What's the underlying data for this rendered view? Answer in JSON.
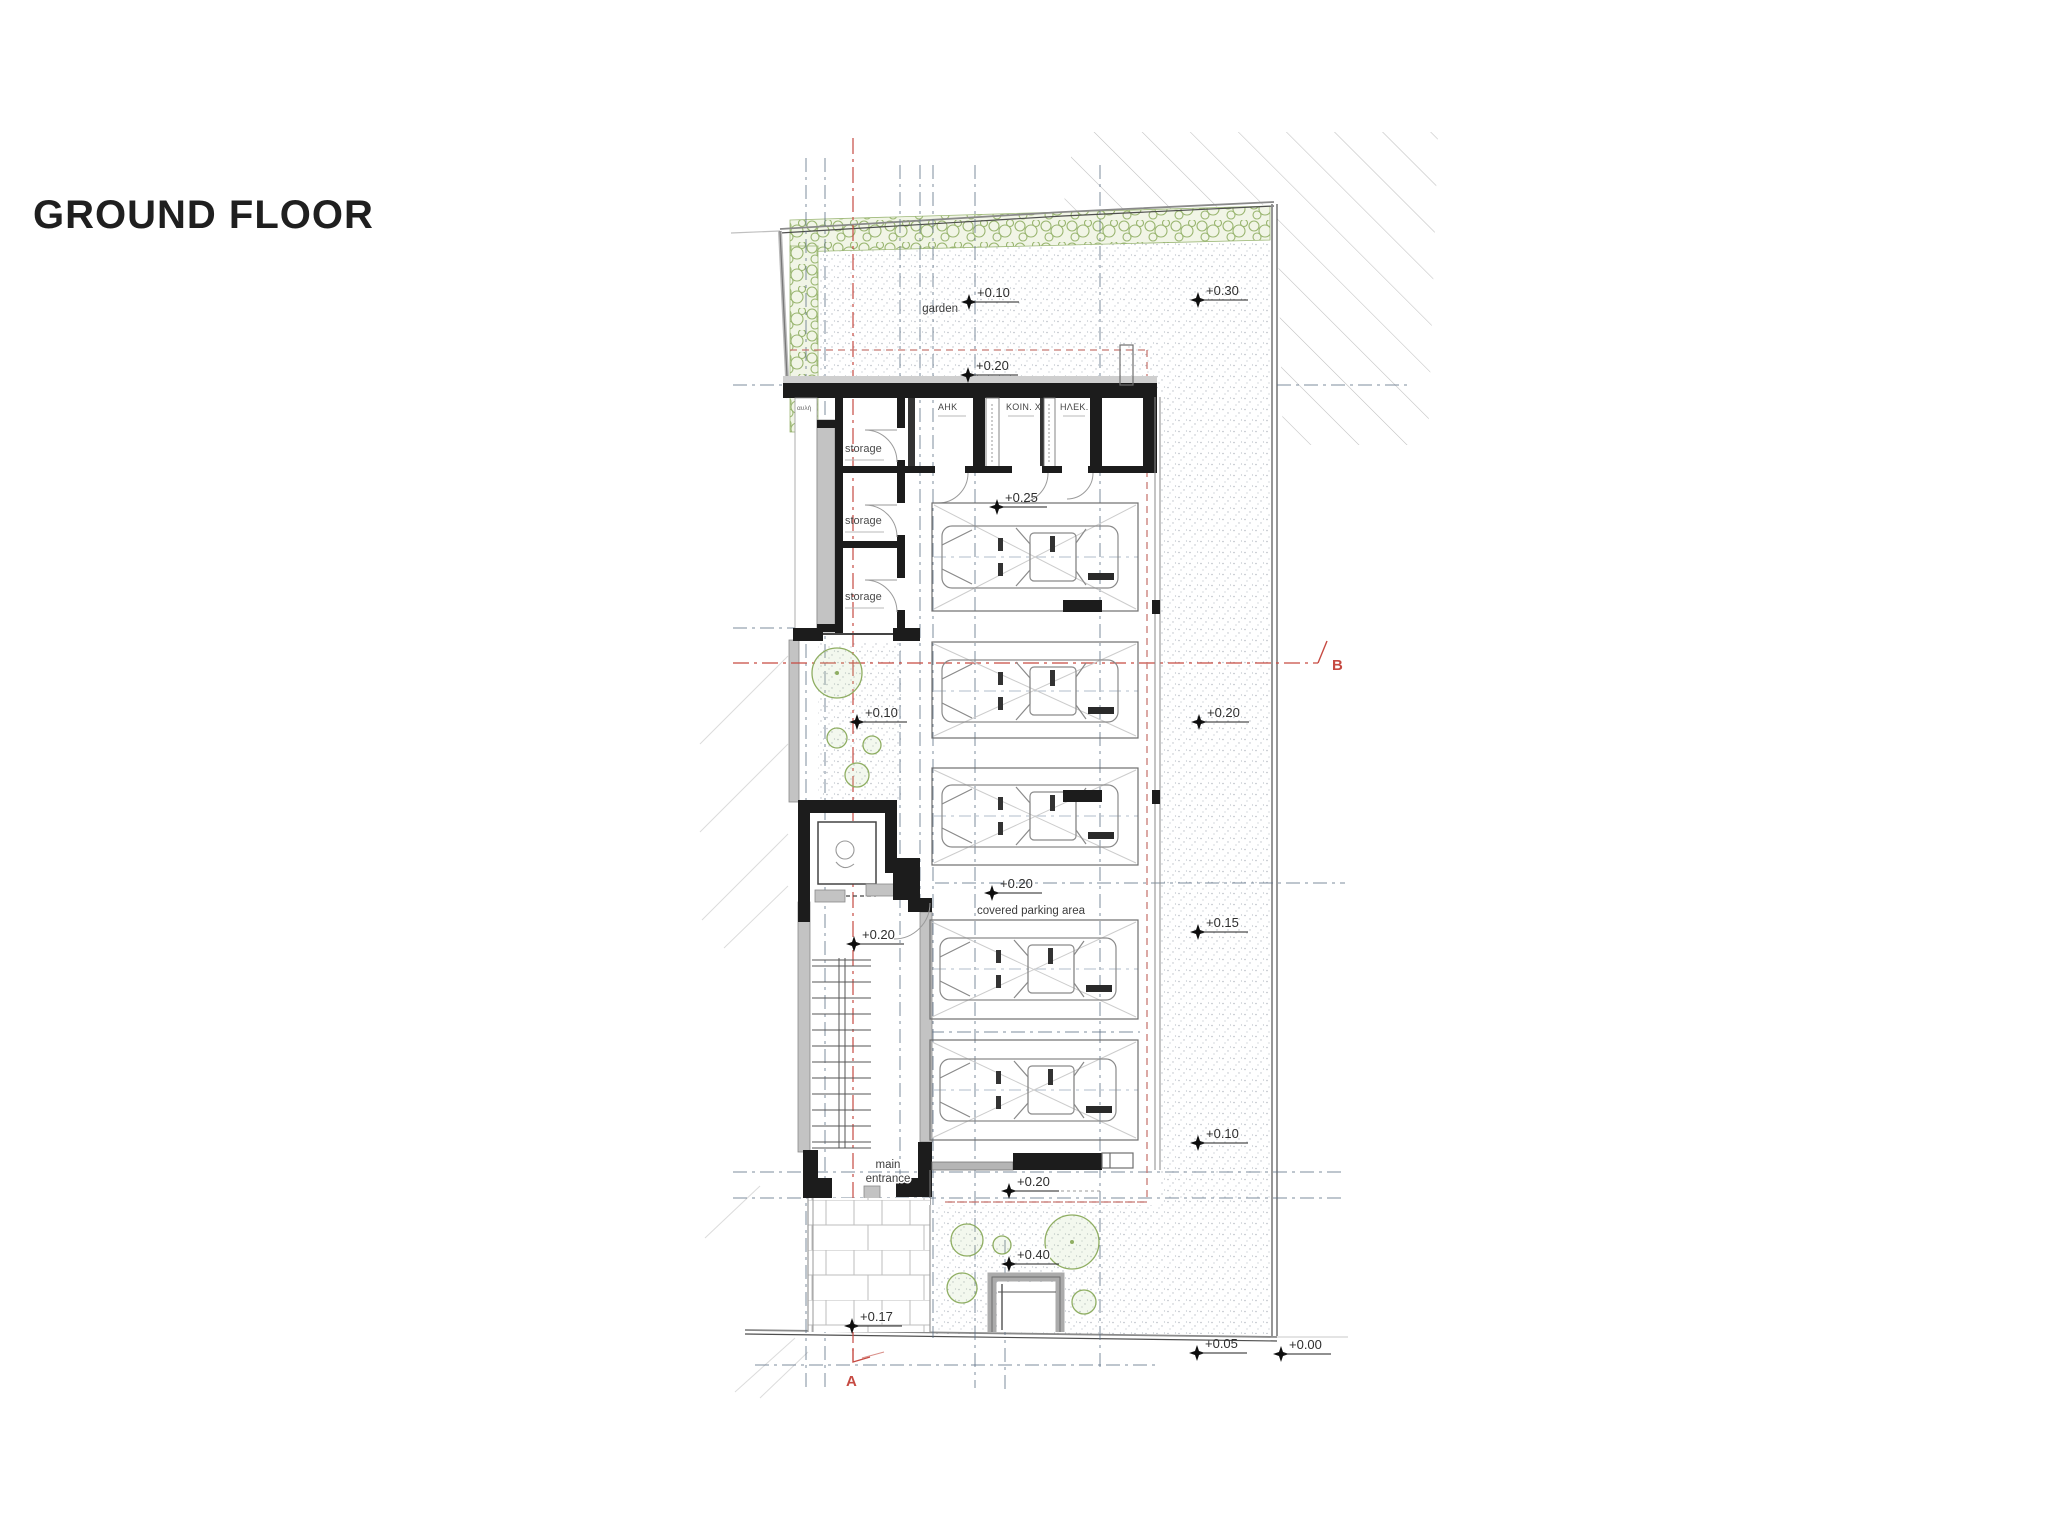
{
  "title": "GROUND FLOOR",
  "plan": {
    "labels": {
      "garden": "garden",
      "covered_parking": "covered parking area",
      "main_entrance_1": "main",
      "main_entrance_2": "entrance",
      "lightwell": "αυλή",
      "storage": "storage",
      "room_ahk": "AHK",
      "room_koin": "KOIN. X",
      "room_hlek": "HΛEK."
    },
    "sections": {
      "a": "A",
      "b": "B"
    },
    "elevations": {
      "garden": "+0.10",
      "site_top_right": "+0.30",
      "terrace_upper": "+0.20",
      "rooms_front": "+0.25",
      "court": "+0.10",
      "site_right_1": "+0.20",
      "parking": "+0.20",
      "site_right_2": "+0.15",
      "stair_hall": "+0.20",
      "site_right_3": "+0.10",
      "entrance_court": "+0.20",
      "gate_court": "+0.40",
      "walkway": "+0.17",
      "street_level_1": "+0.05",
      "street_level_2": "+0.00"
    },
    "colors": {
      "walls": "#1c1c1c",
      "section_line_red": "#c64a42",
      "envelope_red": "#c87a74",
      "centerline_blue": "#5c6f86",
      "vegetation_green": "#8fae62",
      "stipple_gray": "#9aa1ab",
      "boundary_gray": "#7d7d7d"
    }
  }
}
